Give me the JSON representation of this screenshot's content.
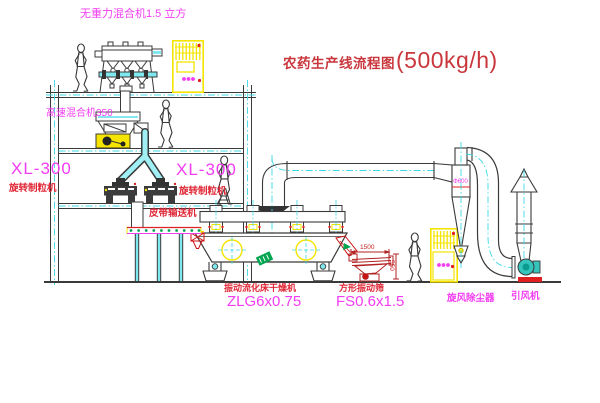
{
  "title": {
    "text_cn": "农药生产线流程图",
    "capacity": "(500kg/h)"
  },
  "equipment_labels": {
    "gravity_mixer": "无重力混合机1.5 立方",
    "high_speed_mixer": "高速混合机350",
    "granulator_left_model": "XL-300",
    "granulator_left_name": "旋转制粒机",
    "granulator_right_model": "XL-300",
    "granulator_right_name": "旋转制粒机",
    "belt_conveyor": "皮带输送机",
    "fluid_bed_dryer_name": "振动流化床干燥机",
    "fluid_bed_dryer_model": "ZLG6x0.75",
    "vibrating_screen_name": "方形振动筛",
    "vibrating_screen_model": "FS0.6x1.5",
    "cyclone_dust_collector": "旋风除尘器",
    "induced_draft_fan": "引风机"
  },
  "dimension_labels": {
    "screen_length": "1500",
    "screen_height": "550",
    "cyclone_diameter": "Φ600"
  },
  "colors": {
    "line": "#3a3a3a",
    "centerline_cyan": "#3cd9e6",
    "cabinet_yellow": "#f5e400",
    "accent_red": "#e02020",
    "label_magenta": "#f23cf2",
    "label_red": "#e02837",
    "title_red": "#c9363c",
    "green": "#00a550"
  }
}
